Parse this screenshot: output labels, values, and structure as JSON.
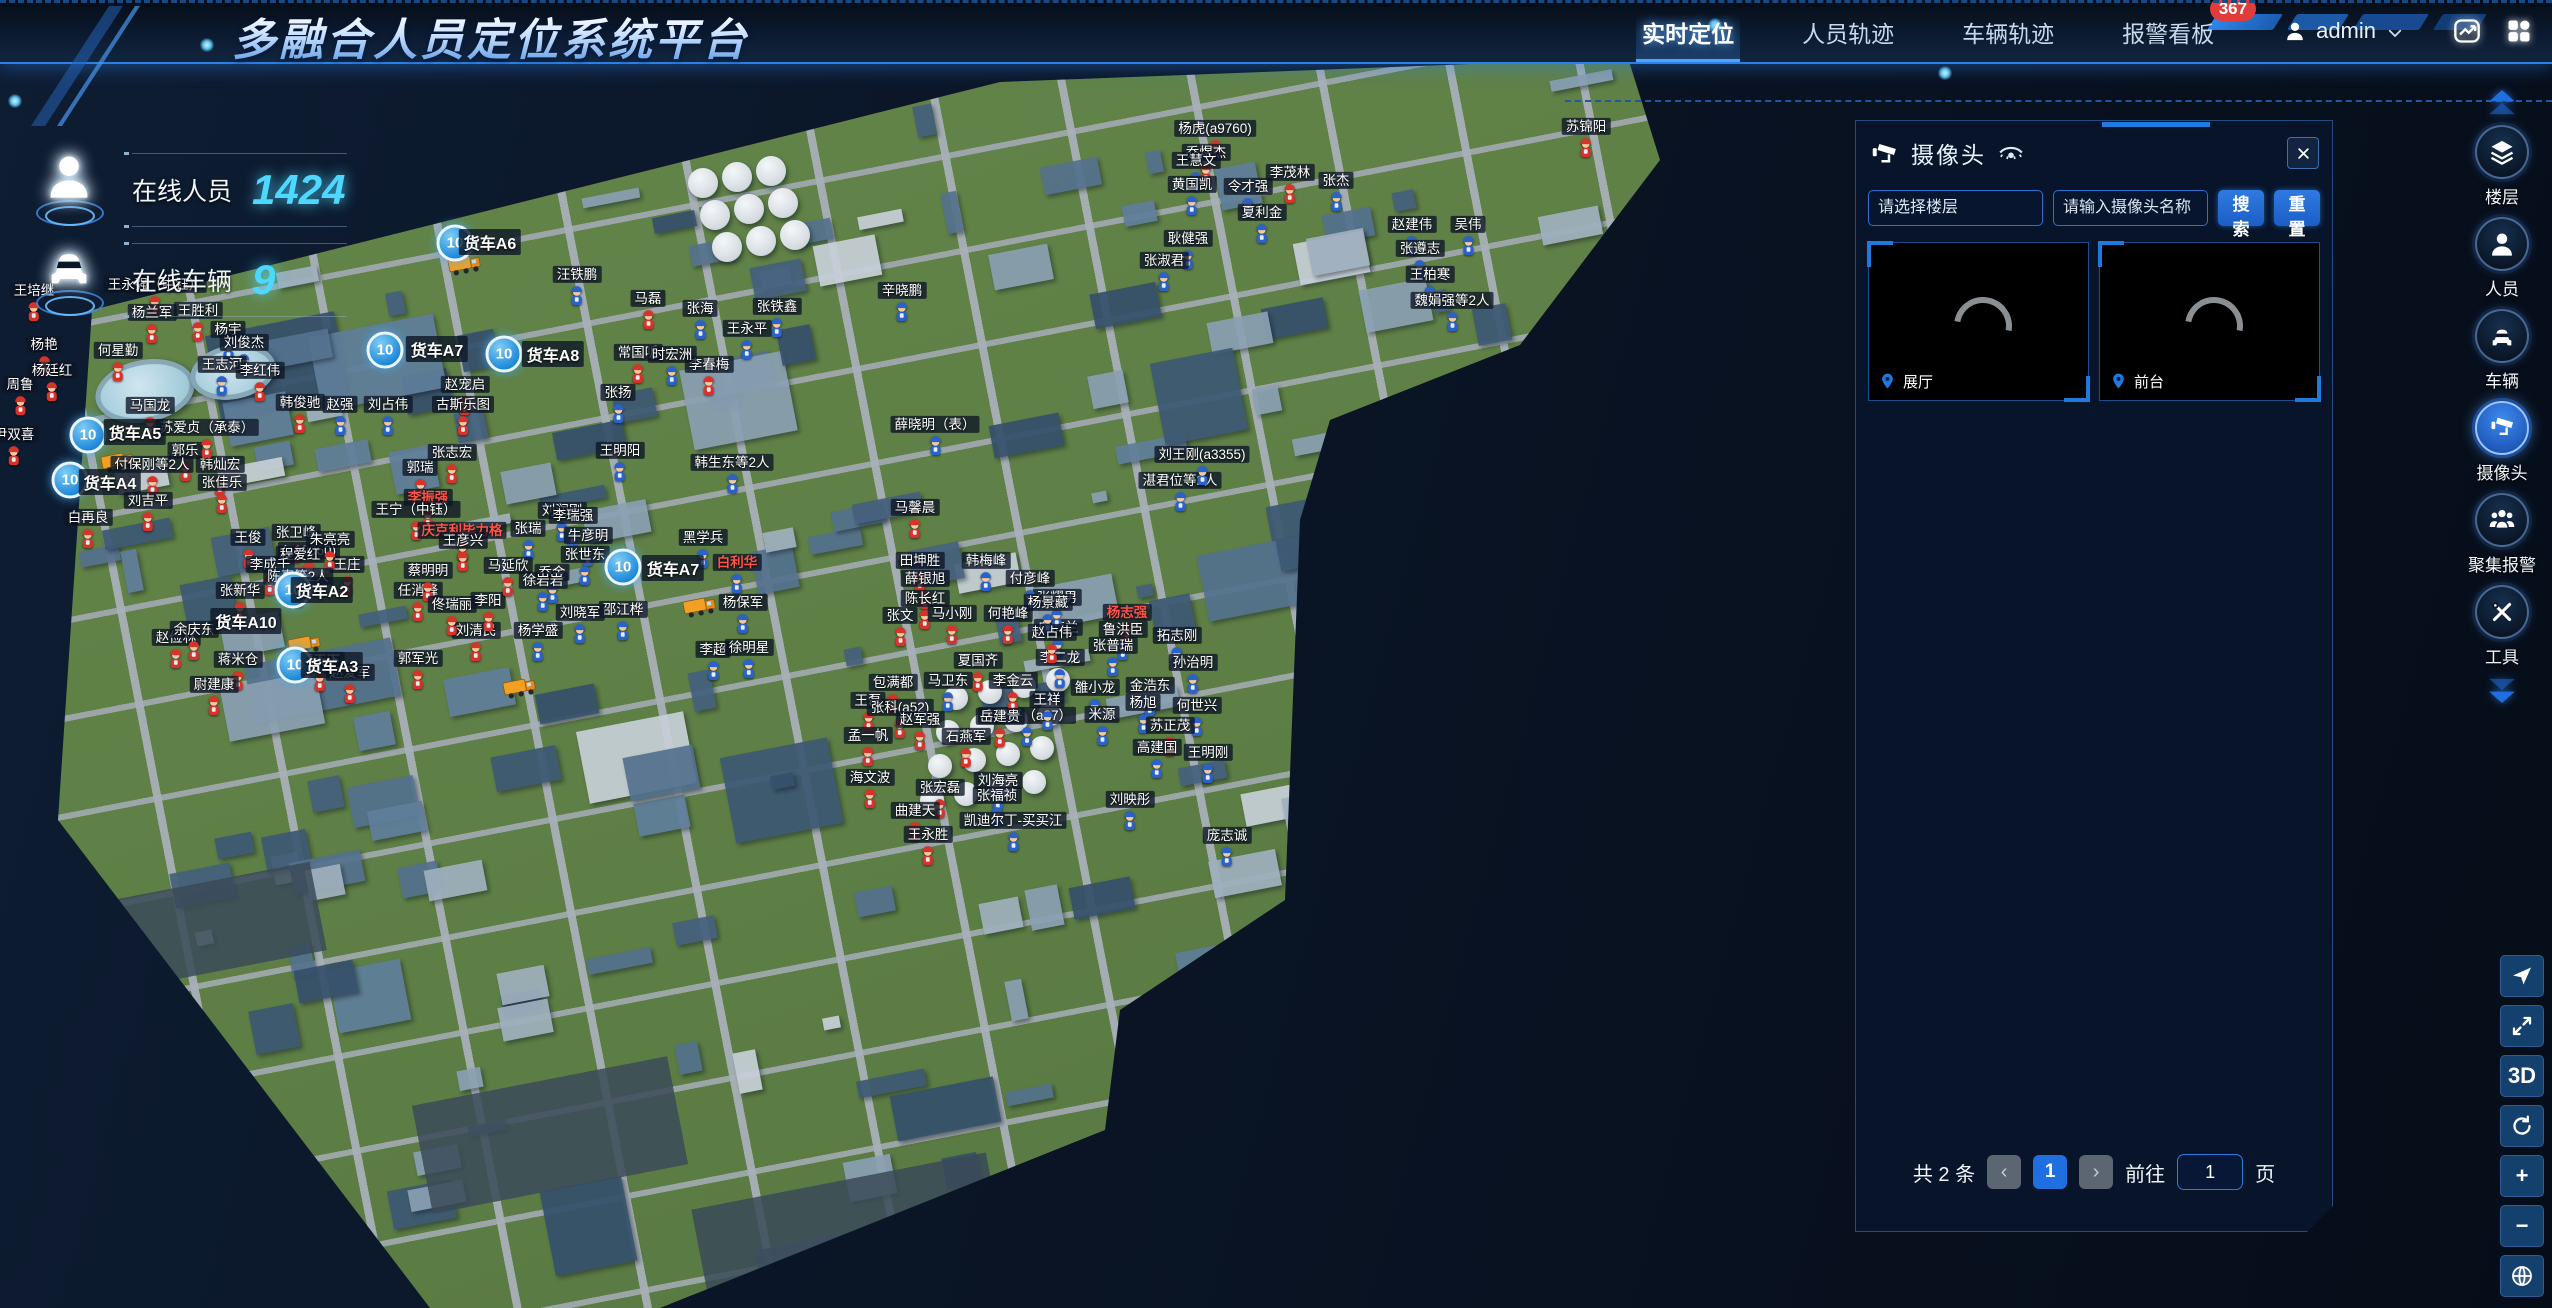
{
  "colors": {
    "accent": "#2f7ae0",
    "alert": "#e23c39",
    "cyan": "#4fd8ff",
    "cluster": "#1b86d8"
  },
  "header": {
    "title": "多融合人员定位系统平台",
    "nav": [
      {
        "label": "实时定位",
        "active": true,
        "badge": ""
      },
      {
        "label": "人员轨迹",
        "active": false,
        "badge": ""
      },
      {
        "label": "车辆轨迹",
        "active": false,
        "badge": ""
      },
      {
        "label": "报警看板",
        "active": false,
        "badge": "367"
      }
    ],
    "user": {
      "name": "admin"
    }
  },
  "stats": [
    {
      "label": "在线人员",
      "value": "1424",
      "icon": "person"
    },
    {
      "label": "在线车辆",
      "value": "9",
      "icon": "car"
    }
  ],
  "camera_panel": {
    "title": "摄像头",
    "floor_select_placeholder": "请选择楼层",
    "name_input_placeholder": "请输入摄像头名称",
    "search_button": "搜索",
    "reset_button": "重置",
    "feeds": [
      {
        "name": "展厅"
      },
      {
        "name": "前台"
      }
    ],
    "pagination": {
      "total_text": "共 2 条",
      "prev": "‹",
      "current_page": "1",
      "next": "›",
      "goto_text": "前往",
      "goto_value": "1",
      "unit_text": "页"
    }
  },
  "sidebar": {
    "items": [
      {
        "label": "楼层",
        "icon": "layers",
        "active": false
      },
      {
        "label": "人员",
        "icon": "person",
        "active": false
      },
      {
        "label": "车辆",
        "icon": "car",
        "active": false
      },
      {
        "label": "摄像头",
        "icon": "camera",
        "active": true
      },
      {
        "label": "聚集报警",
        "icon": "group-alarm",
        "active": false
      },
      {
        "label": "工具",
        "icon": "tools",
        "active": false
      }
    ]
  },
  "map_tools": [
    {
      "id": "compass",
      "icon": "compass",
      "label": ""
    },
    {
      "id": "fullscreen",
      "icon": "fullscreen",
      "label": ""
    },
    {
      "id": "view-3d",
      "icon": "",
      "label": "3D"
    },
    {
      "id": "orbit",
      "icon": "orbit",
      "label": ""
    },
    {
      "id": "zoom-in",
      "icon": "",
      "label": "+"
    },
    {
      "id": "zoom-out",
      "icon": "",
      "label": "−"
    },
    {
      "id": "globe",
      "icon": "globe",
      "label": ""
    }
  ],
  "map": {
    "people": [
      [
        1215,
        160,
        "杨虎(a9760)",
        "r",
        0
      ],
      [
        1206,
        184,
        "乔煜杰",
        "r",
        0
      ],
      [
        1586,
        158,
        "苏锦阳",
        "r",
        0
      ],
      [
        1290,
        204,
        "李茂林",
        "r",
        0
      ],
      [
        1196,
        192,
        "王慧文",
        "b",
        0
      ],
      [
        1192,
        216,
        "黄国凯",
        "b",
        0
      ],
      [
        1248,
        218,
        "令才强",
        "b",
        0
      ],
      [
        1262,
        244,
        "夏利金",
        "b",
        0
      ],
      [
        1336,
        212,
        "张杰",
        "b",
        0
      ],
      [
        1412,
        256,
        "赵建伟",
        "b",
        0
      ],
      [
        1468,
        256,
        "吴伟",
        "b",
        0
      ],
      [
        1420,
        280,
        "张遵志",
        "b",
        0
      ],
      [
        1430,
        306,
        "王柏寒",
        "b",
        0
      ],
      [
        1188,
        270,
        "耿健强",
        "b",
        0
      ],
      [
        1164,
        292,
        "张淑君",
        "b",
        0
      ],
      [
        1452,
        332,
        "魏娟强等2人",
        "b",
        0
      ],
      [
        1180,
        512,
        "湛君位等2人",
        "b",
        0
      ],
      [
        1202,
        486,
        "刘王刚(a3355)",
        "b",
        0
      ],
      [
        648,
        330,
        "马磊",
        "r",
        0
      ],
      [
        700,
        340,
        "张海",
        "b",
        0
      ],
      [
        638,
        384,
        "常国听",
        "r",
        0
      ],
      [
        709,
        396,
        "李春梅",
        "r",
        0
      ],
      [
        672,
        386,
        "时宏洲",
        "b",
        0
      ],
      [
        577,
        306,
        "汪铁鹏",
        "b",
        0
      ],
      [
        777,
        338,
        "张铁鑫",
        "b",
        0
      ],
      [
        747,
        360,
        "王永平",
        "b",
        0
      ],
      [
        618,
        424,
        "张扬",
        "b",
        0
      ],
      [
        902,
        322,
        "辛晓鹏",
        "b",
        0
      ],
      [
        935,
        456,
        "薛晓明（表）",
        "b",
        0
      ],
      [
        465,
        416,
        "赵宠启",
        "r",
        0
      ],
      [
        463,
        436,
        "古斯乐图",
        "r",
        0
      ],
      [
        452,
        484,
        "张志宏",
        "r",
        0
      ],
      [
        420,
        499,
        "郭瑞",
        "r",
        0
      ],
      [
        428,
        529,
        "李振强",
        "r",
        1
      ],
      [
        416,
        541,
        "王宁（中钰）",
        "r",
        0
      ],
      [
        462,
        562,
        "庆克利毕力格",
        "r",
        1
      ],
      [
        34,
        322,
        "王培继",
        "r",
        0
      ],
      [
        155,
        316,
        "王永强（中钰）",
        "r",
        0
      ],
      [
        152,
        344,
        "杨兰军",
        "r",
        0
      ],
      [
        198,
        342,
        "王胜利",
        "r",
        0
      ],
      [
        44,
        376,
        "杨艳",
        "r",
        0
      ],
      [
        52,
        402,
        "杨廷红",
        "r",
        0
      ],
      [
        20,
        416,
        "周鲁",
        "r",
        0
      ],
      [
        14,
        466,
        "尹双喜",
        "r",
        0
      ],
      [
        118,
        382,
        "何星勤",
        "r",
        0
      ],
      [
        228,
        361,
        "杨宇",
        "b",
        0
      ],
      [
        244,
        374,
        "刘俊杰",
        "b",
        0
      ],
      [
        222,
        396,
        "王志河",
        "b",
        0
      ],
      [
        260,
        402,
        "李红伟",
        "r",
        0
      ],
      [
        150,
        437,
        "马国龙",
        "r",
        0
      ],
      [
        185,
        482,
        "郭乐",
        "r",
        0
      ],
      [
        152,
        496,
        "付保刚等2人",
        "r",
        0
      ],
      [
        220,
        496,
        "韩灿宏",
        "r",
        0
      ],
      [
        88,
        549,
        "白再良",
        "r",
        0
      ],
      [
        148,
        532,
        "刘吉平",
        "r",
        0
      ],
      [
        222,
        514,
        "张佳乐",
        "r",
        0
      ],
      [
        300,
        434,
        "韩俊驰",
        "r",
        0
      ],
      [
        340,
        436,
        "赵强",
        "b",
        0
      ],
      [
        388,
        436,
        "刘占伟",
        "b",
        0
      ],
      [
        207,
        459,
        "苏爱贞（承泰）",
        "r",
        0
      ],
      [
        296,
        564,
        "张卫峰",
        "r",
        0
      ],
      [
        309,
        582,
        "(a10060)",
        "r",
        0
      ],
      [
        347,
        596,
        "王庄",
        "r",
        0
      ],
      [
        248,
        569,
        "王俊",
        "r",
        0
      ],
      [
        300,
        586,
        "程爱红",
        "r",
        0
      ],
      [
        270,
        596,
        "李成千",
        "r",
        0
      ],
      [
        330,
        571,
        "朱亮亮",
        "r",
        0
      ],
      [
        240,
        622,
        "张新华",
        "r",
        0
      ],
      [
        298,
        608,
        "陈真等2人",
        "r",
        0
      ],
      [
        320,
        692,
        "惠天下",
        "r",
        0
      ],
      [
        418,
        690,
        "郭军光",
        "r",
        0
      ],
      [
        176,
        669,
        "赵俭林",
        "r",
        0
      ],
      [
        194,
        661,
        "余庆东",
        "r",
        0
      ],
      [
        238,
        691,
        "蒋米仓",
        "r",
        0
      ],
      [
        476,
        662,
        "刘清民",
        "r",
        0
      ],
      [
        418,
        622,
        "任消峰",
        "r",
        0
      ],
      [
        428,
        602,
        "蔡明明",
        "r",
        0
      ],
      [
        452,
        636,
        "佟瑞丽",
        "r",
        0
      ],
      [
        488,
        632,
        "李阳",
        "r",
        0
      ],
      [
        538,
        662,
        "杨学盛",
        "b",
        0
      ],
      [
        214,
        716,
        "尉建康",
        "r",
        0
      ],
      [
        350,
        704,
        "赵爱军",
        "r",
        0
      ],
      [
        703,
        569,
        "黑学兵",
        "b",
        0
      ],
      [
        737,
        594,
        "白利华",
        "b",
        1
      ],
      [
        552,
        604,
        "乔金",
        "b",
        0
      ],
      [
        623,
        641,
        "邵江桦",
        "b",
        0
      ],
      [
        743,
        634,
        "杨保军",
        "b",
        0
      ],
      [
        713,
        681,
        "李超",
        "b",
        0
      ],
      [
        749,
        679,
        "徐明星",
        "b",
        0
      ],
      [
        620,
        482,
        "王明阳",
        "b",
        0
      ],
      [
        732,
        494,
        "韩生东等2人",
        "b",
        0
      ],
      [
        562,
        542,
        "刘润刚",
        "b",
        0
      ],
      [
        573,
        547,
        "李瑞强",
        "b",
        0
      ],
      [
        528,
        560,
        "张瑞",
        "b",
        0
      ],
      [
        588,
        567,
        "牛彦明",
        "b",
        0
      ],
      [
        585,
        586,
        "张世东",
        "b",
        0
      ],
      [
        463,
        572,
        "王彦兴",
        "r",
        0
      ],
      [
        508,
        597,
        "马延欣",
        "r",
        0
      ],
      [
        543,
        612,
        "徐岩岩",
        "b",
        0
      ],
      [
        580,
        644,
        "刘晓军",
        "b",
        0
      ],
      [
        1058,
        659,
        "白海兰",
        "b",
        0
      ],
      [
        1060,
        689,
        "李二龙",
        "b",
        0
      ],
      [
        1057,
        629,
        "张耀男",
        "b",
        0
      ],
      [
        1127,
        644,
        "杨志强",
        "r",
        1
      ],
      [
        1123,
        661,
        "鲁洪臣",
        "b",
        0
      ],
      [
        1113,
        677,
        "张普瑞",
        "b",
        0
      ],
      [
        1177,
        667,
        "拓志刚",
        "b",
        0
      ],
      [
        1193,
        694,
        "孙治明",
        "b",
        0
      ],
      [
        893,
        714,
        "包满都",
        "r",
        0
      ],
      [
        948,
        712,
        "马卫东",
        "b",
        0
      ],
      [
        868,
        732,
        "王磊",
        "r",
        0
      ],
      [
        900,
        739,
        "张科(a52)",
        "r",
        0
      ],
      [
        920,
        751,
        "赵军强",
        "r",
        0
      ],
      [
        868,
        767,
        "孟一帆",
        "r",
        0
      ],
      [
        1095,
        719,
        "雒小龙",
        "b",
        0
      ],
      [
        1150,
        717,
        "金浩东",
        "b",
        0
      ],
      [
        1143,
        734,
        "杨旭",
        "b",
        0
      ],
      [
        1027,
        747,
        "李建平（a27）",
        "b",
        0
      ],
      [
        1102,
        746,
        "米源",
        "b",
        0
      ],
      [
        1047,
        731,
        "王祥",
        "b",
        0
      ],
      [
        1197,
        737,
        "何世兴",
        "b",
        0
      ],
      [
        1170,
        757,
        "苏正茂",
        "r",
        0
      ],
      [
        1157,
        779,
        "高建国",
        "b",
        0
      ],
      [
        1208,
        784,
        "王明刚",
        "b",
        0
      ],
      [
        870,
        809,
        "海文波",
        "r",
        0
      ],
      [
        940,
        819,
        "张宏磊",
        "r",
        0
      ],
      [
        998,
        812,
        "刘海亮",
        "b",
        0
      ],
      [
        997,
        827,
        "张福祯",
        "b",
        0
      ],
      [
        915,
        842,
        "曲建天",
        "r",
        0
      ],
      [
        928,
        866,
        "王永胜",
        "r",
        0
      ],
      [
        1013,
        852,
        "凯迪尔丁-买买江",
        "b",
        0
      ],
      [
        1130,
        831,
        "刘映彤",
        "b",
        0
      ],
      [
        1227,
        867,
        "庞志诚",
        "b",
        0
      ],
      [
        1030,
        610,
        "付彦峰",
        "b",
        0
      ],
      [
        1048,
        634,
        "杨景藏",
        "b",
        0
      ],
      [
        915,
        539,
        "马馨晨",
        "r",
        0
      ],
      [
        920,
        592,
        "田坤胜",
        "r",
        0
      ],
      [
        986,
        592,
        "韩梅峰",
        "b",
        0
      ],
      [
        925,
        610,
        "薛银旭",
        "r",
        0
      ],
      [
        925,
        630,
        "陈长红",
        "r",
        0
      ],
      [
        900,
        647,
        "张文",
        "r",
        0
      ],
      [
        952,
        645,
        "马小刚",
        "r",
        0
      ],
      [
        1008,
        645,
        "何艳峰",
        "r",
        0
      ],
      [
        1052,
        664,
        "赵占伟",
        "r",
        0
      ],
      [
        978,
        692,
        "夏国齐",
        "r",
        0
      ],
      [
        1013,
        712,
        "李金云",
        "r",
        0
      ],
      [
        966,
        768,
        "石燕军",
        "r",
        0
      ],
      [
        1000,
        748,
        "岳建贵",
        "r",
        0
      ]
    ],
    "clusters": [
      [
        455,
        243,
        "10"
      ],
      [
        385,
        350,
        "10"
      ],
      [
        504,
        354,
        "10"
      ],
      [
        88,
        435,
        "10"
      ],
      [
        70,
        480,
        "10"
      ],
      [
        293,
        590,
        "10"
      ],
      [
        295,
        665,
        "10"
      ],
      [
        623,
        567,
        "10"
      ]
    ],
    "truck_labels": [
      [
        490,
        242,
        "货车A6"
      ],
      [
        437,
        349,
        "货车A7"
      ],
      [
        553,
        354,
        "货车A8"
      ],
      [
        135,
        432,
        "货车A5"
      ],
      [
        110,
        482,
        "货车A4"
      ],
      [
        322,
        590,
        "货车A2"
      ],
      [
        246,
        621,
        "货车A10"
      ],
      [
        332,
        665,
        "货车A3"
      ],
      [
        673,
        568,
        "货车A7"
      ]
    ],
    "truck_icons": [
      [
        700,
        607
      ],
      [
        118,
        462
      ],
      [
        305,
        645
      ],
      [
        520,
        688
      ],
      [
        465,
        265
      ]
    ]
  }
}
